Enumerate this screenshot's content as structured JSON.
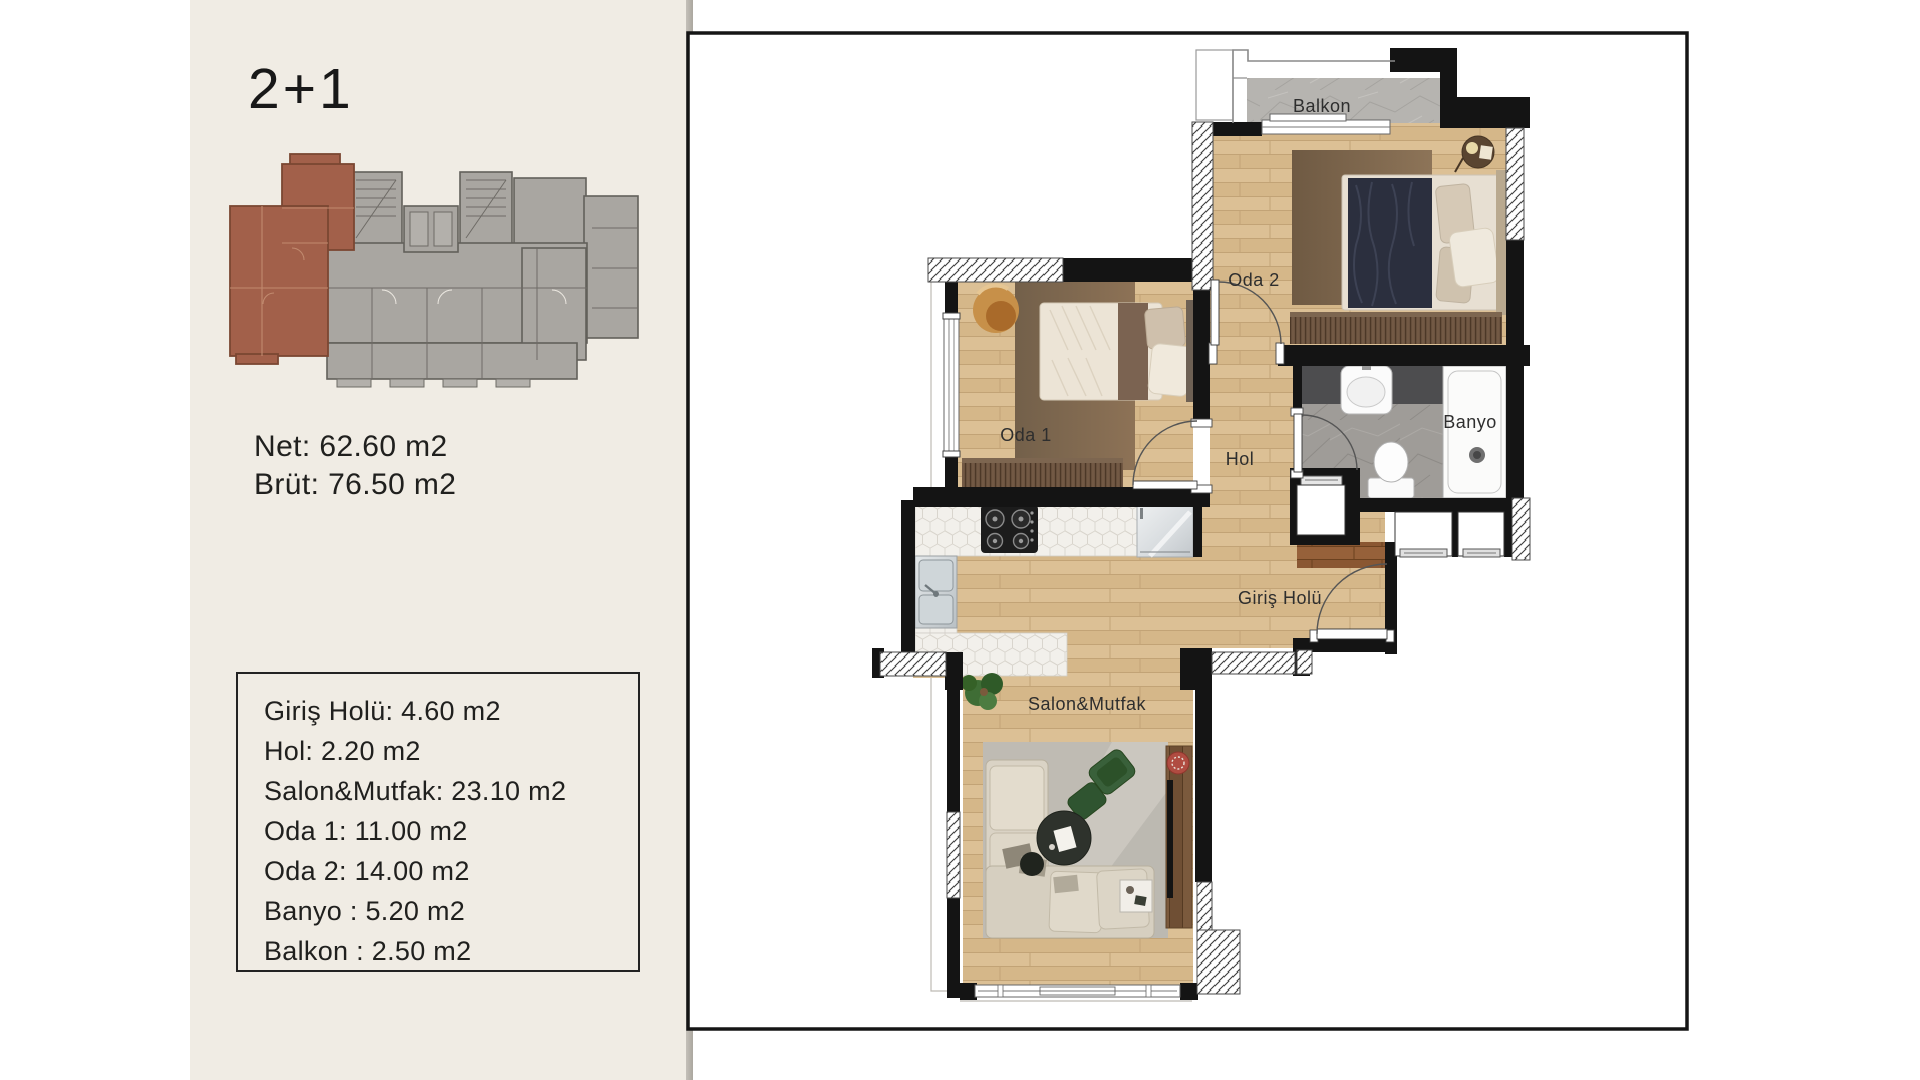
{
  "sidebar": {
    "unit_type": "2+1",
    "net": "Net: 62.60 m2",
    "brut": "Brüt: 76.50 m2",
    "areas": [
      "Giriş Holü: 4.60 m2",
      "Hol: 2.20 m2",
      "Salon&Mutfak: 23.10 m2",
      "Oda 1: 11.00 m2",
      "Oda 2: 14.00 m2",
      "Banyo : 5.20 m2",
      "Balkon : 2.50 m2"
    ]
  },
  "plan": {
    "labels": {
      "balkon": "Balkon",
      "oda2": "Oda 2",
      "oda1": "Oda 1",
      "hol": "Hol",
      "banyo": "Banyo",
      "giris": "Giriş Holü",
      "salon": "Salon&Mutfak"
    }
  },
  "colors": {
    "sidebar_bg": "#f0ece4",
    "highlight_unit": "#a2604a",
    "wall": "#141414",
    "wood_floor": "#dcc095",
    "hatch_line": "#3c3c3c"
  }
}
